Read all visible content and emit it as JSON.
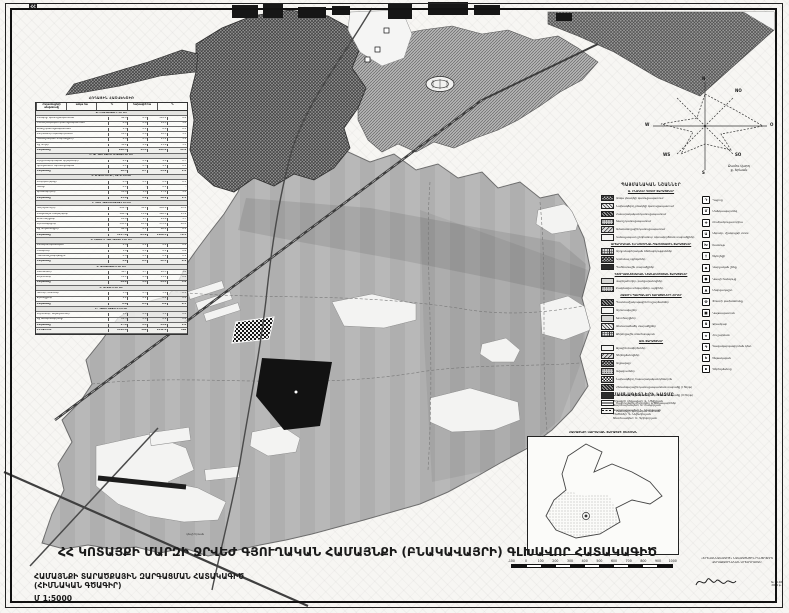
{
  "corner_mark": "ՀՀ",
  "map_label": "դեպի Երևան",
  "colors": {
    "paper": "#f7f6f3",
    "ink": "#1a1a1a",
    "land": "#b8b8b8",
    "urban_hatch": "#343434",
    "black_zone": "#161616"
  },
  "land_table": {
    "title": "ՀՈՂԱՅԻՆ ՀԱՇՎԵԿՇԻՌ",
    "columns": [
      "Հողատեսքերի անվանումը",
      "առկա հա",
      "%",
      "նախագիծ հա",
      "%"
    ],
    "rows": [
      [
        "Ա. ԲՆԱԿԱՎԱՅՐԻ ՀՈՂԵՐ",
        "",
        "",
        "",
        "",
        "sec"
      ],
      [
        "Բնակելի կառուցապատման",
        "96.4",
        "6.8",
        "118.2",
        "8.4",
        ""
      ],
      [
        "Հասարակական կառուցապատման",
        "8.6",
        "0.6",
        "14.3",
        "1.0",
        ""
      ],
      [
        "Խառը կառուցապատման",
        "2.4",
        "0.2",
        "6.8",
        "0.5",
        ""
      ],
      [
        "Ընդհանուր օգտագործման",
        "12.1",
        "0.9",
        "18.5",
        "1.3",
        ""
      ],
      [
        "Կանաչապատ տարածքներ",
        "6.8",
        "0.5",
        "15.2",
        "1.1",
        ""
      ],
      [
        "Այլ հողեր",
        "34.2",
        "2.4",
        "21.6",
        "1.5",
        ""
      ],
      [
        "Ընդամենը",
        "160.5",
        "11.4",
        "194.6",
        "13.8",
        "tot"
      ],
      [
        "Բ. ԱՐԴՅՈՒՆԱԲԵՐՈՒԹՅԱՆ ՀՈՂԵՐ",
        "",
        "",
        "",
        "",
        "sec"
      ],
      [
        "Արդյունաբերական օբյեկտների",
        "6.2",
        "0.4",
        "9.8",
        "0.7",
        ""
      ],
      [
        "Գյուղատնտ. արտադրական",
        "4.1",
        "0.3",
        "4.1",
        "0.3",
        ""
      ],
      [
        "Ընդամենը",
        "10.3",
        "0.7",
        "13.9",
        "1.0",
        "tot"
      ],
      [
        "Գ. ՏՐԱՆՍՊՈՐՏԻ, ԿԱՊԻ ՀՈՂԵՐ",
        "",
        "",
        "",
        "",
        "sec"
      ],
      [
        "Էներգետիկայի",
        "0.8",
        "0.1",
        "0.8",
        "0.1",
        ""
      ],
      [
        "Կապի",
        "0.2",
        "-",
        "0.2",
        "-",
        ""
      ],
      [
        "Տրանսպորտի",
        "14.6",
        "1.0",
        "17.2",
        "1.2",
        ""
      ],
      [
        "Ընդամենը",
        "15.6",
        "1.1",
        "18.2",
        "1.3",
        "tot"
      ],
      [
        "Դ. ԳՅՈՒՂԱՏՆՏԵՍԱԿԱՆ ՀՈՂԵՐ",
        "",
        "",
        "",
        "",
        "sec"
      ],
      [
        "Վարելահողեր",
        "482.5",
        "34.2",
        "456.8",
        "32.4",
        ""
      ],
      [
        "Բազմամյա տնկարկներ",
        "168.3",
        "11.9",
        "168.3",
        "11.9",
        ""
      ],
      [
        "Խոտհարքներ",
        "24.6",
        "1.7",
        "24.6",
        "1.7",
        ""
      ],
      [
        "Արոտավայրեր",
        "395.2",
        "28.0",
        "372.4",
        "26.4",
        ""
      ],
      [
        "Այլ հողատեսքեր",
        "86.4",
        "6.1",
        "86.4",
        "6.1",
        ""
      ],
      [
        "Ընդամենը",
        "1157.0",
        "81.9",
        "1108.5",
        "78.5",
        "tot"
      ],
      [
        "Ե. ՀԱՏՈՒԿ ՊԱՀՊԱՆՎՈՂ ՀՈՂԵՐ",
        "",
        "",
        "",
        "",
        "sec"
      ],
      [
        "Բնապահպանական",
        "2.4",
        "0.2",
        "2.4",
        "0.2",
        ""
      ],
      [
        "Հանգստի",
        "1.6",
        "0.1",
        "8.2",
        "0.6",
        ""
      ],
      [
        "Պատմամշակութային",
        "0.9",
        "0.1",
        "0.9",
        "0.1",
        ""
      ],
      [
        "Ընդամենը",
        "4.9",
        "0.4",
        "11.5",
        "0.9",
        "tot"
      ],
      [
        "Զ. ԱՆՏԱՌԱՅԻՆ ՀՈՂԵՐ",
        "",
        "",
        "",
        "",
        "sec"
      ],
      [
        "Անտառներ",
        "38.7",
        "2.7",
        "42.3",
        "3.0",
        ""
      ],
      [
        "Թփուտներ",
        "11.2",
        "0.8",
        "11.2",
        "0.8",
        ""
      ],
      [
        "Ընդամենը",
        "49.9",
        "3.5",
        "53.5",
        "3.8",
        "tot"
      ],
      [
        "Է. ՋՐԱՅԻՆ ՀՈՂԵՐ",
        "",
        "",
        "",
        "",
        "sec"
      ],
      [
        "Գետեր, առուներ",
        "3.8",
        "0.3",
        "3.8",
        "0.3",
        ""
      ],
      [
        "Ջրանցքներ",
        "2.2",
        "0.2",
        "2.2",
        "0.2",
        ""
      ],
      [
        "Ընդամենը",
        "6.0",
        "0.5",
        "6.0",
        "0.5",
        "tot"
      ],
      [
        "Ը. ՊԱՀՈՒՍՏԱՅԻՆ ՀՈՂԵՐ",
        "",
        "",
        "",
        "",
        "sec"
      ],
      [
        "Աղուտներ, ավազուտներ",
        "5.1",
        "0.4",
        "5.1",
        "0.4",
        ""
      ],
      [
        "Այլ անօգտագործելի",
        "12.5",
        "0.9",
        "8.9",
        "0.6",
        ""
      ],
      [
        "Ընդամենը",
        "17.6",
        "1.3",
        "14.0",
        "1.0",
        "tot"
      ],
      [
        "ԸՆԴԱՄԵՆԸ",
        "1412.8",
        "100",
        "1412.8",
        "100",
        "tot"
      ]
    ]
  },
  "wind_rose": {
    "n": "N",
    "no": "NO",
    "o": "O",
    "so": "SO",
    "s": "S",
    "ws": "WS",
    "w": "W",
    "cap1": "Քամու վարդ",
    "cap2": "ք. Երևան"
  },
  "legend": {
    "title": "ՊԱՅՄԱՆԱԿԱՆ ՆՇԱՆՆԵՐ",
    "rows": [
      {
        "k": "h",
        "l": "Ա. ԲՆԱԿԵԼԻ ԳՈՏՈՒ ՏԱՐԱԾՔՆԵՐ"
      },
      {
        "k": "i",
        "p": "cross-dark",
        "l": "Առկա բնակելի կառուցապատում"
      },
      {
        "k": "i",
        "p": "diag",
        "l": "Նախագծվող բնակելի կառուցապատում"
      },
      {
        "k": "i",
        "p": "dense",
        "l": "Հասարակական կառուցապատում"
      },
      {
        "k": "i",
        "p": "dots",
        "l": "Խառը կառուցապատում"
      },
      {
        "k": "i",
        "p": "diag2",
        "l": "Ամառանոցային կառուցապատում"
      },
      {
        "k": "i",
        "p": "blank",
        "l": "Կանաչապատ ընդհանուր օգտագործման տարածքներ"
      },
      {
        "k": "h",
        "l": "ԱՐՏԱԴՐԱԿԱՆ ԵՎ ԿՈՄՈՒՆԱԼ-ՊԱՀԵՍՏԱՅԻՆ ՏԱՐԱԾՔՆԵՐ"
      },
      {
        "k": "i",
        "p": "grid",
        "l": "Արդյունաբերական ձեռնարկություններ"
      },
      {
        "k": "i",
        "p": "cross-dark",
        "l": "Կոմունալ օբյեկտներ"
      },
      {
        "k": "i",
        "p": "solid-dark",
        "l": "Պահեստային տարածքներ"
      },
      {
        "k": "h",
        "l": "ԳՅՈՒՂԱՏՆՏԵՍԱԿԱՆ ՆՇԱՆԱԿՈՒԹՅԱՆ ՏԱՐԱԾՔՆԵՐ"
      },
      {
        "k": "i",
        "p": "light",
        "l": "Վարելահողեր, բանջարանոցներ"
      },
      {
        "k": "i",
        "p": "dots",
        "l": "Բազմամյա տնկարկներ, այգիներ"
      },
      {
        "k": "h",
        "l": "ՀԱՏՈՒԿ ՊԱՀՊԱՆՎՈՂ ՏԱՐԱԾՔՆԵՐԻ ՀՈՂԵՐ"
      },
      {
        "k": "i",
        "p": "dense",
        "l": "Պատմամշակութային հուշարձաններ"
      },
      {
        "k": "i",
        "p": "blank",
        "l": "Արոտավայրեր"
      },
      {
        "k": "i",
        "p": "light",
        "l": "Խոտհարքներ"
      },
      {
        "k": "i",
        "p": "diag",
        "l": "Անտառածածկ տարածքներ"
      },
      {
        "k": "i",
        "p": "grid",
        "l": "Ջերմոցային տնտեսություն"
      },
      {
        "k": "h",
        "l": "ԱՅԼ ՏԱՐԱԾՔՆԵՐ"
      },
      {
        "k": "i",
        "p": "blank",
        "l": "Ջրային մակերեսներ"
      },
      {
        "k": "i",
        "p": "diag2",
        "l": "Գերեզմանոցներ"
      },
      {
        "k": "i",
        "p": "cross-dark",
        "l": "Աղբավայր"
      },
      {
        "k": "i",
        "p": "dots",
        "l": "Ավազուտներ"
      },
      {
        "k": "i",
        "p": "checker",
        "l": "Նախագծվող հասարակական կենտրոն"
      },
      {
        "k": "i",
        "p": "dense",
        "l": "Հեռանկարային կառուցապատման տարածք (I հերթ)"
      },
      {
        "k": "i",
        "p": "solid-dark",
        "l": "Հեռանկարային կառուցապատման տարածք (II հերթ)"
      },
      {
        "k": "i",
        "p": "road",
        "l": "Մայրուղային փողոցներ և ճանապարհներ"
      },
      {
        "k": "i",
        "p": "bound",
        "l": "Համայնքի վարչական սահման"
      }
    ],
    "icons": [
      {
        "g": "Դ",
        "l": "Դպրոց"
      },
      {
        "g": "Մ",
        "l": "Մանկապարտեզ"
      },
      {
        "g": "✚",
        "l": "Բուժամբուլատորիա"
      },
      {
        "g": "Ա",
        "l": "Ակումբ, մշակույթի տուն"
      },
      {
        "g": "Խ",
        "l": "Խանութ"
      },
      {
        "g": "†",
        "l": "Եկեղեցի"
      },
      {
        "g": "◆",
        "l": "Վարչական շենք"
      },
      {
        "g": "●",
        "l": "Կապի հանգույց"
      },
      {
        "g": "▲",
        "l": "Մարզադաշտ"
      },
      {
        "g": "Փ",
        "l": "Փոստի բաժանմունք"
      },
      {
        "g": "■",
        "l": "Կաթսայատուն"
      },
      {
        "g": "Ջ",
        "l": "Ջրամբար"
      },
      {
        "g": "★",
        "l": "Հուշարձան"
      },
      {
        "g": "Գ",
        "l": "Գազակարգավորման կետ"
      },
      {
        "g": "Ե",
        "l": "Ենթակայան"
      },
      {
        "g": "▪",
        "l": "Գերեզմանոց"
      }
    ]
  },
  "specialists": {
    "title": "ՄԱՍՆԱԳԵՏՆԵՐԻ ԿԱԶՄԸ",
    "lines": [
      "Ծրագրի ղեկավար՝ Վ. Մելիքյան",
      "Ճարտարապետ՝ Ա. Հակոբյան",
      "Ճարտարապետ՝ Ն. Սարգսյան",
      "Ինժեներ՝ Գ. Ավետիսյան",
      "Տնտեսագետ՝ Ս. Գրիգորյան"
    ]
  },
  "inset": {
    "title": "ՀԱՄԱՅՆՔԻ ՎԱՐՉԱԿԱՆ ՏԱՐԱԾՔԻ ՍԽԵՄԱՆ"
  },
  "scale_bar": {
    "labels": [
      "-100",
      "0",
      "100",
      "200",
      "300",
      "400",
      "500",
      "600",
      "700",
      "800",
      "900",
      "1000"
    ]
  },
  "title_block": {
    "main": "ՀՀ ԿՈՏԱՅՔԻ ՄԱՐԶԻ ՋՐՎԵԺ ԳՅՈՒՂԱԿԱՆ ՀԱՄԱՅՆՔԻ (ԲՆԱԿԱՎԱՅՐԻ) ԳԼԽԱՎՈՐ ՀԱՏԱԿԱԳԻԾ",
    "sub1": "ՀԱՄԱՅՆՔԻ ՏԱՐԱԾՔԱՅԻՆ ԶԱՐԳԱՑՄԱՆ ՀԱՏԱԿԱԳԻԾ",
    "sub2": "(ՀԻՄՆԱԿԱՆ ԳԾԱԳԻՐ)",
    "scale": "Մ 1:5000"
  },
  "credits": {
    "line1": "«ԵՐԵՎԱՆՆԱԽԱԳԻԾ» ՆԱԽԱԳԾԱՅԻՆ ԻՆՍՏԻՏՈՒՏ",
    "line2": "ՔԱՂԱՔԱՇԻՆԱԿԱՆ ԱՐՏԱԴՐԱՄԱՍ",
    "stamp1": "№ 14-02",
    "stamp2": "2004 թ."
  }
}
